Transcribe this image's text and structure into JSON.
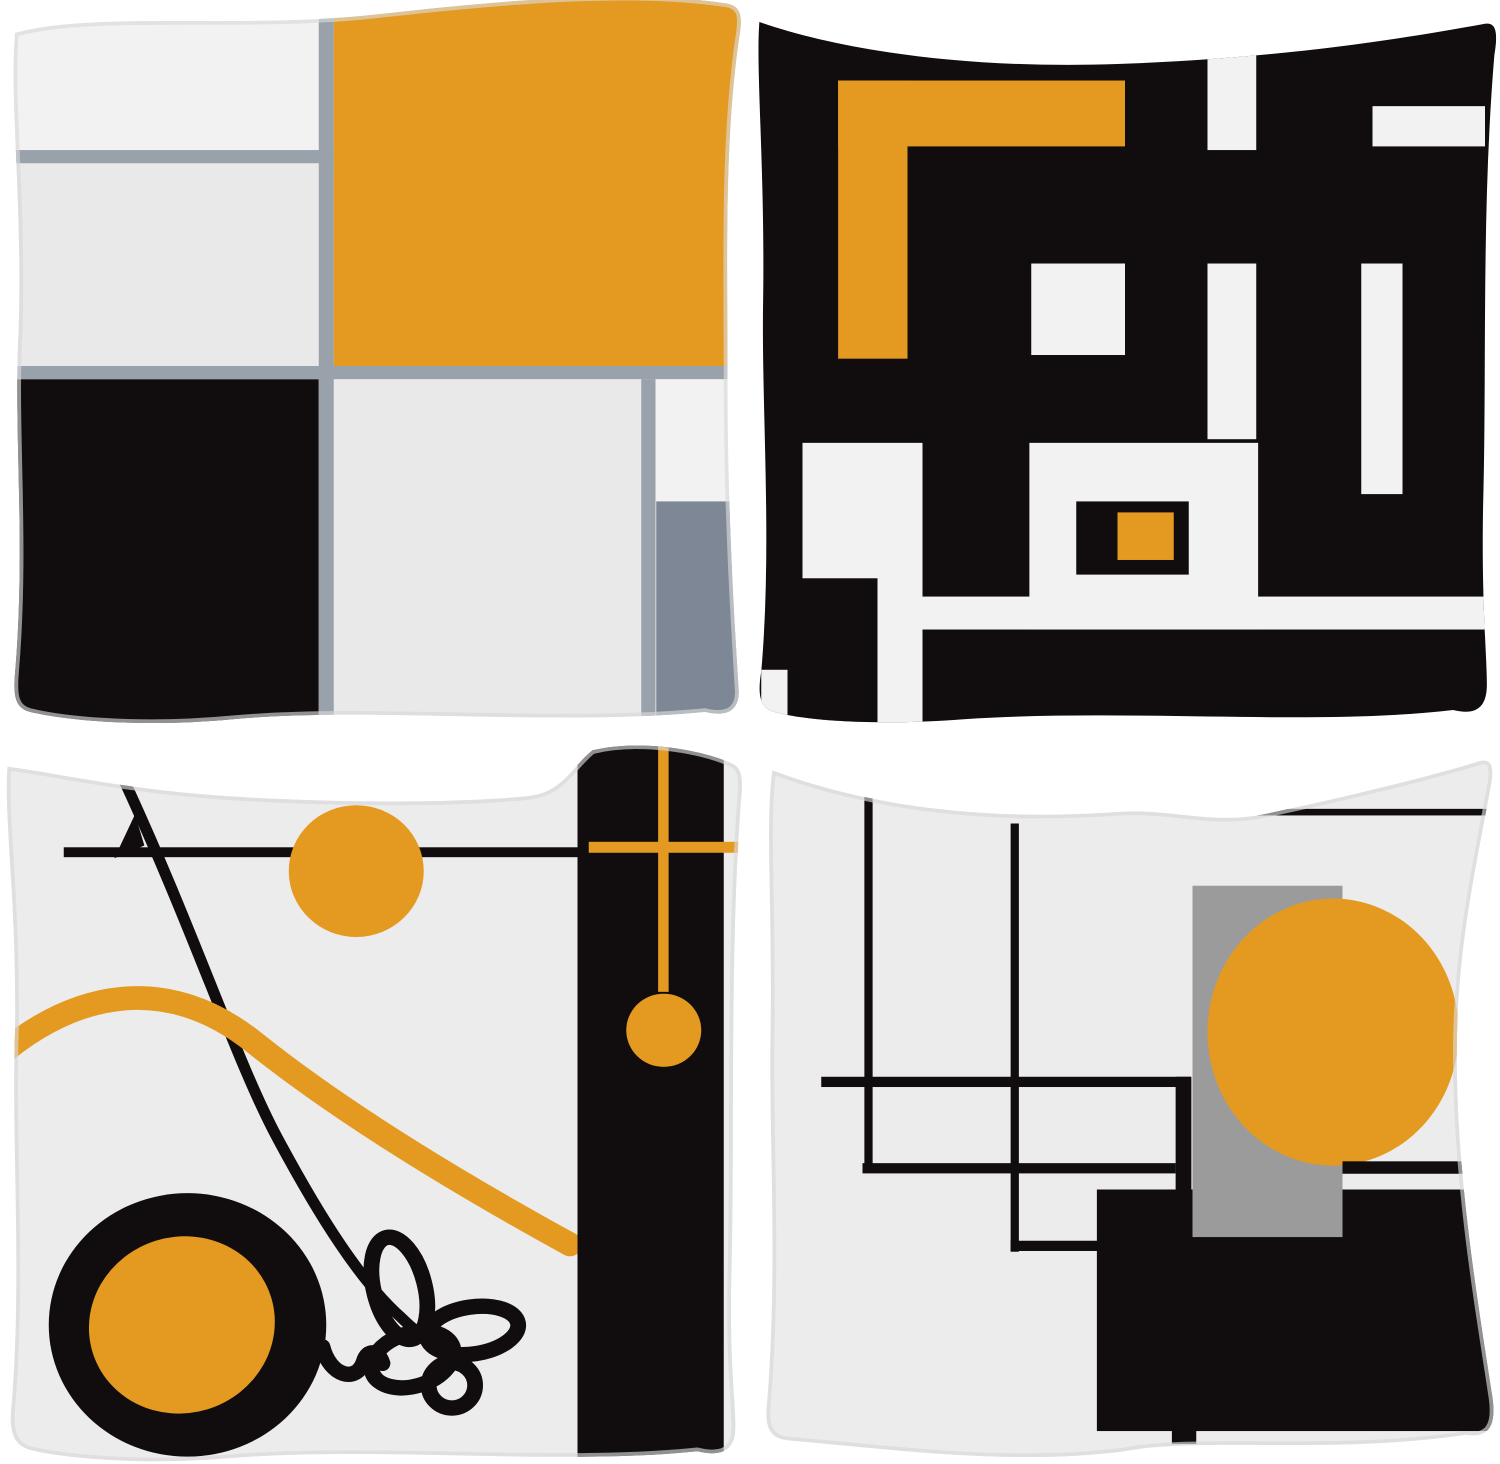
{
  "page": {
    "title": "4-pack abstract geometric throw pillow covers - product photo",
    "background": "#FFFFFF",
    "grid": {
      "rows": 2,
      "cols": 2
    }
  },
  "palette": {
    "orange": "#E49A20",
    "ink": "#110D0E",
    "slate_line": "#99A1AB",
    "slate_block": "#7E8795",
    "neutral_gray": "#9B9B9B",
    "fabric_light": "#ECECEC",
    "fabric_lighter": "#F2F2F2",
    "fabric_mid": "#E9E9E9",
    "page_bg": "#FFFFFF"
  },
  "pillows": [
    {
      "id": "mondrian-grid",
      "position": "top-left",
      "description": "Pillow with Mondrian style color block grid: white and light gray panels divided by slate gray lines, large orange square at top right, black block at bottom left, slate gray block at bottom right"
    },
    {
      "id": "black-maze",
      "position": "top-right",
      "description": "Black pillow with white geometric maze bars, an orange corner L shape at top left and a small orange square in a black frame near bottom center"
    },
    {
      "id": "line-art",
      "position": "bottom-left",
      "description": "Light gray pillow with abstract line art: orange sun, orange wavy stripe, black wheel with orange hub, tangled scribble line, and a black side column with orange cross and hanging orange ball"
    },
    {
      "id": "grid-circle",
      "position": "bottom-right",
      "description": "Light gray pillow with thin black grid lines, a neutral gray rectangle, a large orange circle and a black block in the bottom right corner"
    }
  ]
}
